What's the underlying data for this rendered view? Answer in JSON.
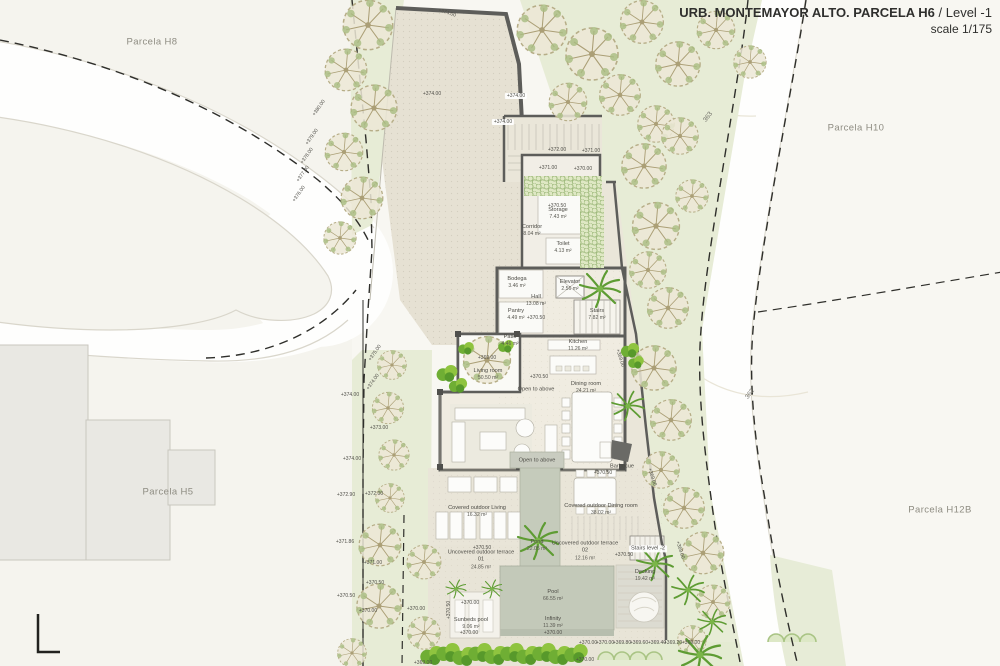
{
  "title": {
    "project": "URB. MONTEMAYOR ALTO. PARCELA H6",
    "level": " / Level -1",
    "scale": "scale 1/175"
  },
  "plan": {
    "parcels": [
      {
        "t": "Parcela H8",
        "x": 152,
        "y": 42
      },
      {
        "t": "Parcela H10",
        "x": 856,
        "y": 128
      },
      {
        "t": "Parcela H5",
        "x": 168,
        "y": 492
      },
      {
        "t": "Parcela H12B",
        "x": 940,
        "y": 510
      }
    ],
    "rooms": [
      {
        "name": "Storage",
        "area": "7.43 m²",
        "x": 558,
        "y": 214
      },
      {
        "name": "Corridor",
        "area": "8.04 m²",
        "x": 532,
        "y": 231
      },
      {
        "name": "Toilet",
        "area": "4.13 m²",
        "x": 563,
        "y": 248
      },
      {
        "name": "Bodega",
        "area": "3.46 m²",
        "x": 517,
        "y": 283
      },
      {
        "name": "Elevator",
        "area": "2.56 m²",
        "x": 570,
        "y": 286
      },
      {
        "name": "Hall",
        "area": "13.08 m²",
        "x": 536,
        "y": 301
      },
      {
        "name": "Stairs",
        "area": "7.82 m²",
        "x": 597,
        "y": 315
      },
      {
        "name": "Pantry",
        "area": "4.49 m²",
        "x": 516,
        "y": 315
      },
      {
        "name": "Patio",
        "area": "4.46 m²",
        "x": 510,
        "y": 341
      },
      {
        "name": "Kitchen",
        "area": "11.26 m²",
        "x": 578,
        "y": 346
      },
      {
        "name": "Living room",
        "area": "50.50 m²",
        "x": 488,
        "y": 375
      },
      {
        "name": "Dining room",
        "area": "24.21 m²",
        "x": 586,
        "y": 388
      },
      {
        "name": "Covered outdoor Living",
        "area": "16.32 m²",
        "x": 477,
        "y": 512,
        "w": 72
      },
      {
        "name": "Covered outdoor Dining room",
        "area": "38.02 m²",
        "x": 601,
        "y": 510,
        "w": 84
      },
      {
        "name": "Pond",
        "area": "22.05 m²",
        "x": 537,
        "y": 546
      },
      {
        "name": "Uncovered outdoor terrace 01",
        "area": "24.85 m²",
        "x": 481,
        "y": 560,
        "w": 72
      },
      {
        "name": "Uncovered outdoor terrace 02",
        "area": "12.16 m²",
        "x": 585,
        "y": 551,
        "w": 72
      },
      {
        "name": "Decking",
        "area": "19.42 m²",
        "x": 645,
        "y": 576
      },
      {
        "name": "Pool",
        "area": "66.55 m²",
        "x": 553,
        "y": 596
      },
      {
        "name": "Infinity",
        "area": "11.39 m²",
        "x": 553,
        "y": 623
      },
      {
        "name": "Sunbeds pool",
        "area": "9.06 m²",
        "x": 471,
        "y": 624,
        "w": 42
      }
    ],
    "notes": [
      {
        "t": "Open to above",
        "x": 536,
        "y": 390
      },
      {
        "t": "Open to above",
        "x": 537,
        "y": 461
      },
      {
        "t": "Stairs level -2",
        "x": 648,
        "y": 549,
        "chip": true
      },
      {
        "t": "Barbecue",
        "x": 622,
        "y": 467
      }
    ],
    "elevations": [
      {
        "t": "+374.00",
        "x": 447,
        "y": 13,
        "r": 18
      },
      {
        "t": "+374.00",
        "x": 432,
        "y": 94
      },
      {
        "t": "+374.00",
        "x": 516,
        "y": 96,
        "chip": true
      },
      {
        "t": "+374.00",
        "x": 503,
        "y": 122,
        "chip": true
      },
      {
        "t": "+372.00",
        "x": 557,
        "y": 150
      },
      {
        "t": "+371.00",
        "x": 591,
        "y": 151
      },
      {
        "t": "+371.00",
        "x": 548,
        "y": 168
      },
      {
        "t": "+370.00",
        "x": 583,
        "y": 169
      },
      {
        "t": "+370.50",
        "x": 557,
        "y": 206
      },
      {
        "t": "+370.50",
        "x": 536,
        "y": 318
      },
      {
        "t": "+370.50",
        "x": 539,
        "y": 377
      },
      {
        "t": "+369.00",
        "x": 487,
        "y": 358
      },
      {
        "t": "+370.50",
        "x": 603,
        "y": 473
      },
      {
        "t": "+370.50",
        "x": 482,
        "y": 548
      },
      {
        "t": "+370.50",
        "x": 624,
        "y": 555
      },
      {
        "t": "+370.00",
        "x": 470,
        "y": 603
      },
      {
        "t": "+370.00",
        "x": 469,
        "y": 633
      },
      {
        "t": "+370.00",
        "x": 553,
        "y": 633
      },
      {
        "t": "+370.50",
        "x": 449,
        "y": 610,
        "r": -90
      },
      {
        "t": "+370.00",
        "x": 588,
        "y": 643
      },
      {
        "t": "+370.00",
        "x": 605,
        "y": 643
      },
      {
        "t": "+369.80",
        "x": 622,
        "y": 643
      },
      {
        "t": "+369.60",
        "x": 639,
        "y": 643
      },
      {
        "t": "+369.40",
        "x": 657,
        "y": 643
      },
      {
        "t": "+369.20",
        "x": 673,
        "y": 643
      },
      {
        "t": "+369.00",
        "x": 691,
        "y": 643
      },
      {
        "t": "+370.00",
        "x": 585,
        "y": 660
      },
      {
        "t": "+369.00",
        "x": 620,
        "y": 358,
        "r": 72
      },
      {
        "t": "+369.00",
        "x": 652,
        "y": 477,
        "r": 72
      },
      {
        "t": "+369.00",
        "x": 680,
        "y": 550,
        "r": 72
      },
      {
        "t": "+380.00",
        "x": 319,
        "y": 108,
        "r": -55
      },
      {
        "t": "+379.00",
        "x": 312,
        "y": 137,
        "r": -55
      },
      {
        "t": "+378.00",
        "x": 307,
        "y": 156,
        "r": -55
      },
      {
        "t": "+377.00",
        "x": 303,
        "y": 174,
        "r": -55
      },
      {
        "t": "+376.00",
        "x": 299,
        "y": 194,
        "r": -55
      },
      {
        "t": "+375.00",
        "x": 375,
        "y": 353,
        "r": -55
      },
      {
        "t": "+374.00",
        "x": 373,
        "y": 382,
        "r": -55
      },
      {
        "t": "+374.00",
        "x": 350,
        "y": 395
      },
      {
        "t": "+373.00",
        "x": 379,
        "y": 428
      },
      {
        "t": "+374.00",
        "x": 352,
        "y": 459
      },
      {
        "t": "+372.90",
        "x": 346,
        "y": 495
      },
      {
        "t": "+372.00",
        "x": 374,
        "y": 494
      },
      {
        "t": "+371.86",
        "x": 345,
        "y": 542
      },
      {
        "t": "+371.00",
        "x": 373,
        "y": 563
      },
      {
        "t": "+370.50",
        "x": 375,
        "y": 583
      },
      {
        "t": "+370.50",
        "x": 346,
        "y": 596
      },
      {
        "t": "+370.00",
        "x": 368,
        "y": 611
      },
      {
        "t": "+370.00",
        "x": 416,
        "y": 609
      },
      {
        "t": "+369.00",
        "x": 423,
        "y": 663
      }
    ],
    "contours": [
      {
        "t": "363",
        "x": 708,
        "y": 117,
        "r": -52
      },
      {
        "t": "362",
        "x": 750,
        "y": 394,
        "r": -52
      }
    ]
  }
}
